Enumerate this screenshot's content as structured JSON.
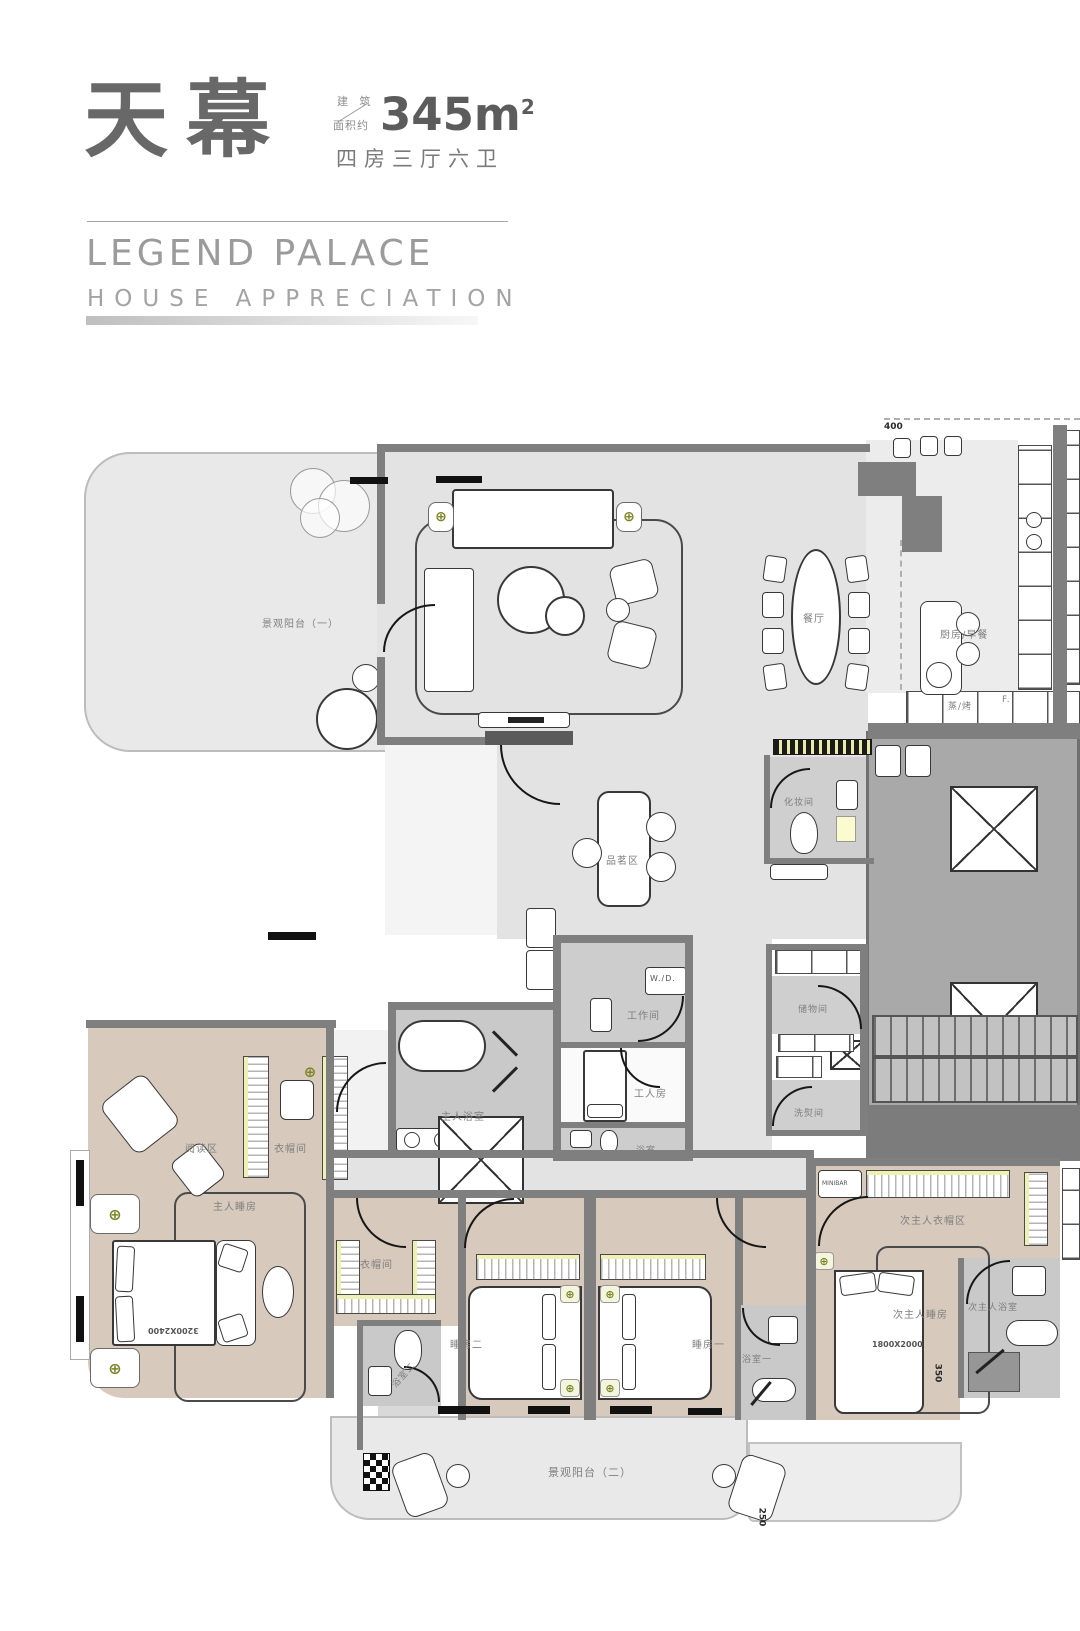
{
  "header": {
    "title_cn": "天幕",
    "area_label_line1": "建 筑",
    "area_label_line2": "面积约",
    "area_value": "345m",
    "area_exponent": "2",
    "layout_text": "四房三厅六卫",
    "subtitle_en": "LEGEND PALACE",
    "subtitle_sub": "HOUSE APPRECIATION"
  },
  "plan": {
    "labels": [
      {
        "label": "景观阳台（一）"
      },
      {
        "label": "餐厅"
      },
      {
        "label": "厨房/早餐"
      },
      {
        "label": "蒸/烤"
      },
      {
        "label": "F."
      },
      {
        "label": "品茗区"
      },
      {
        "label": "化妆间"
      },
      {
        "label": "储物间"
      },
      {
        "label": "洗熨间"
      },
      {
        "label": "工作间"
      },
      {
        "label": "W./D."
      },
      {
        "label": "工人房"
      },
      {
        "label": "浴室"
      },
      {
        "label": "主人浴室"
      },
      {
        "label": "阅读区"
      },
      {
        "label": "衣帽间"
      },
      {
        "label": "主人睡房"
      },
      {
        "label": "衣帽间"
      },
      {
        "label": "浴室二"
      },
      {
        "label": "睡房二"
      },
      {
        "label": "睡房一"
      },
      {
        "label": "浴室一"
      },
      {
        "label": "次主人衣帽区"
      },
      {
        "label": "MINIBAR"
      },
      {
        "label": "次主人睡房"
      },
      {
        "label": "次主人浴室"
      },
      {
        "label": "景观阳台（二）"
      }
    ],
    "dimensions": {
      "d400": "400",
      "d3200": "3200X2400",
      "d1800": "1800X2000",
      "d350": "350",
      "d250": "250"
    },
    "colors": {
      "floor_open": "#e3e3e3",
      "floor_bedroom": "#d7cabc",
      "floor_bath": "#c9c9c9",
      "core": "#a9a9a9",
      "wall": "#7f7f7f",
      "accent_yellow": "#edf2b4",
      "accent_olive": "#7c8428"
    }
  }
}
